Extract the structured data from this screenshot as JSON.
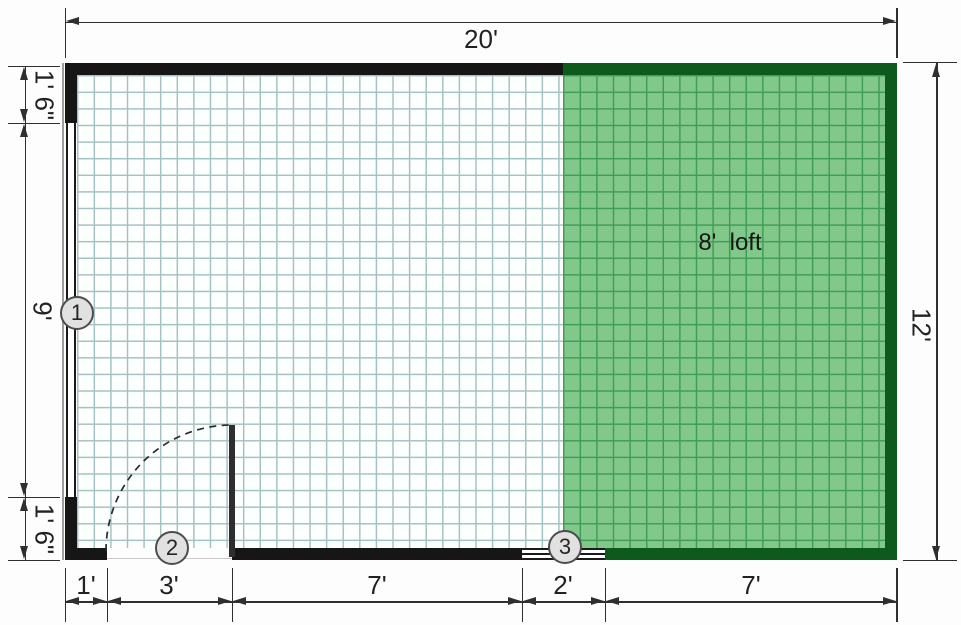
{
  "labels": {
    "top_width": "20'",
    "right_height": "12'",
    "left_top": "1' 6\"",
    "left_middle": "9'",
    "left_bottom": "1' 6\"",
    "bottom_segments": [
      "1'",
      "3'",
      "7'",
      "2'",
      "7'"
    ],
    "loft": "8'  loft"
  },
  "markers": [
    "1",
    "2",
    "3"
  ],
  "colors": {
    "wall": "#161616",
    "loft_wall": "#0e5a1c",
    "loft_fill": "#82c88a",
    "loft_grid_line": "#3f9e55",
    "floor_grid_line": "#a3c2c3",
    "dimension_line": "#2f2f2f",
    "marker_fill": "#e1e1e1",
    "marker_border": "#4d4d4d"
  }
}
